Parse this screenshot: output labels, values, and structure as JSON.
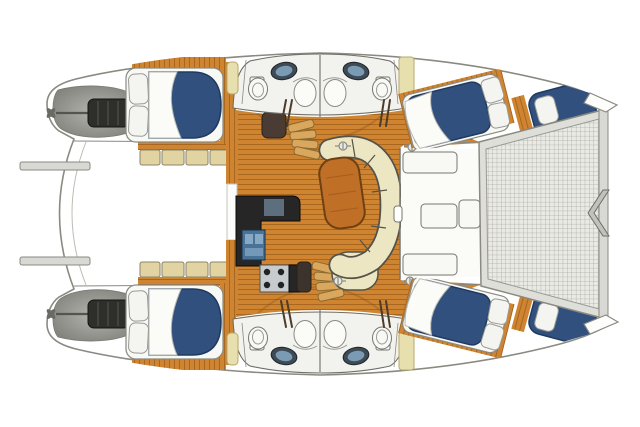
{
  "canvas": {
    "width": 640,
    "height": 427
  },
  "image": {
    "label": "catamaran-yacht-floor-plan-top-view",
    "orientation": {
      "bow": "right",
      "stern": "left"
    }
  },
  "palette": {
    "hull-stroke": "#8A8A82",
    "teak": "#CE8430",
    "teak-stripe": "#A8661F",
    "mattress": "#31507E",
    "mattress-edge": "#1E3A60",
    "pillow": "#F4F4F1",
    "duvet": "#FBFBF8",
    "settee": "#EDE6C3",
    "settee-edge": "#55524A",
    "table-wood": "#C06F26",
    "table-edge": "#6E4012",
    "counter": "#262626",
    "sink": "#4A7296",
    "sink-light": "#86A9C6",
    "stove-steel": "#C7CBCD",
    "burner": "#222222",
    "bench": "#E2D3A2",
    "bench-edge": "#8A8468",
    "tramp-bg": "#EAEAE5",
    "tramp-grid": "#ACACA4",
    "tramp-frame": "#DFDFDA",
    "beam": "#CFCFCA",
    "engine": "#2E2E2A",
    "engine-bay-light": "#B5B5AF",
    "engine-bay-dark": "#7E7E78",
    "fixture-white": "#F8F8F5",
    "fixture-stroke": "#777770",
    "band-fill": "#F2F2EE",
    "pad": "#E8DFAE",
    "steps": "#D9A85E",
    "steps-edge": "#8A6A30",
    "metal": "#D8D8D4"
  },
  "vessel": {
    "features": [
      "port-hull",
      "starboard-hull",
      "bow-trampoline",
      "forward-crossbeam",
      "bow-bridle-fitting",
      "forward-cockpit",
      "saloon",
      "galley",
      "settee",
      "saloon-table",
      "companionway-steps-port",
      "companionway-steps-starboard",
      "aft-cockpit",
      "davit-arms",
      "engine-rooms",
      "prop-shafts",
      "aft-cabin-berths",
      "forward-cabin-berths",
      "forepeak-berths",
      "heads-with-sink-toilet-shower",
      "deck-hatches"
    ]
  }
}
